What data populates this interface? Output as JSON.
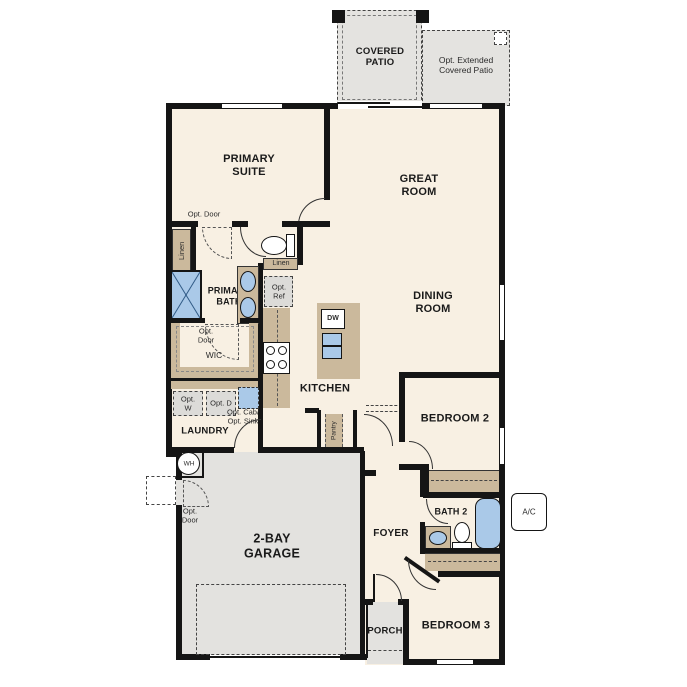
{
  "rooms": {
    "covered_patio": "COVERED PATIO",
    "opt_extended_patio": "Opt. Extended Covered Patio",
    "primary_suite": "PRIMARY SUITE",
    "great_room": "GREAT ROOM",
    "dining_room": "DINING ROOM",
    "primary_bath": "PRIMARY BATH",
    "wic": "WIC",
    "kitchen": "KITCHEN",
    "laundry": "LAUNDRY",
    "pantry": "Pantry",
    "bedroom_2": "BEDROOM 2",
    "foyer": "FOYER",
    "bath_2": "BATH 2",
    "garage": "2-BAY GARAGE",
    "porch": "PORCH",
    "bedroom_3": "BEDROOM 3"
  },
  "annotations": {
    "opt_door_primary": "Opt. Door",
    "opt_door_wic": "Opt. Door",
    "opt_door_garage": "Opt. Door",
    "linen_vertical": "Linen",
    "linen_horizontal": "Linen",
    "opt_ref": "Opt. Ref",
    "opt_washer": "Opt. W",
    "opt_dryer": "Opt. D",
    "opt_cab_sink": "Opt. Cab/ Opt. Sink",
    "dishwasher": "DW",
    "water_heater": "WH",
    "ac_unit": "A/C"
  },
  "colors": {
    "wall": "#151515",
    "room_fill": "#f8f0e3",
    "patio_fill": "#e4e3e0",
    "garage_fill": "#e3e2df",
    "counter_fill": "#cbb99c",
    "fixture_blue": "#aac9e8",
    "option_box_fill": "#dcdbd8"
  }
}
